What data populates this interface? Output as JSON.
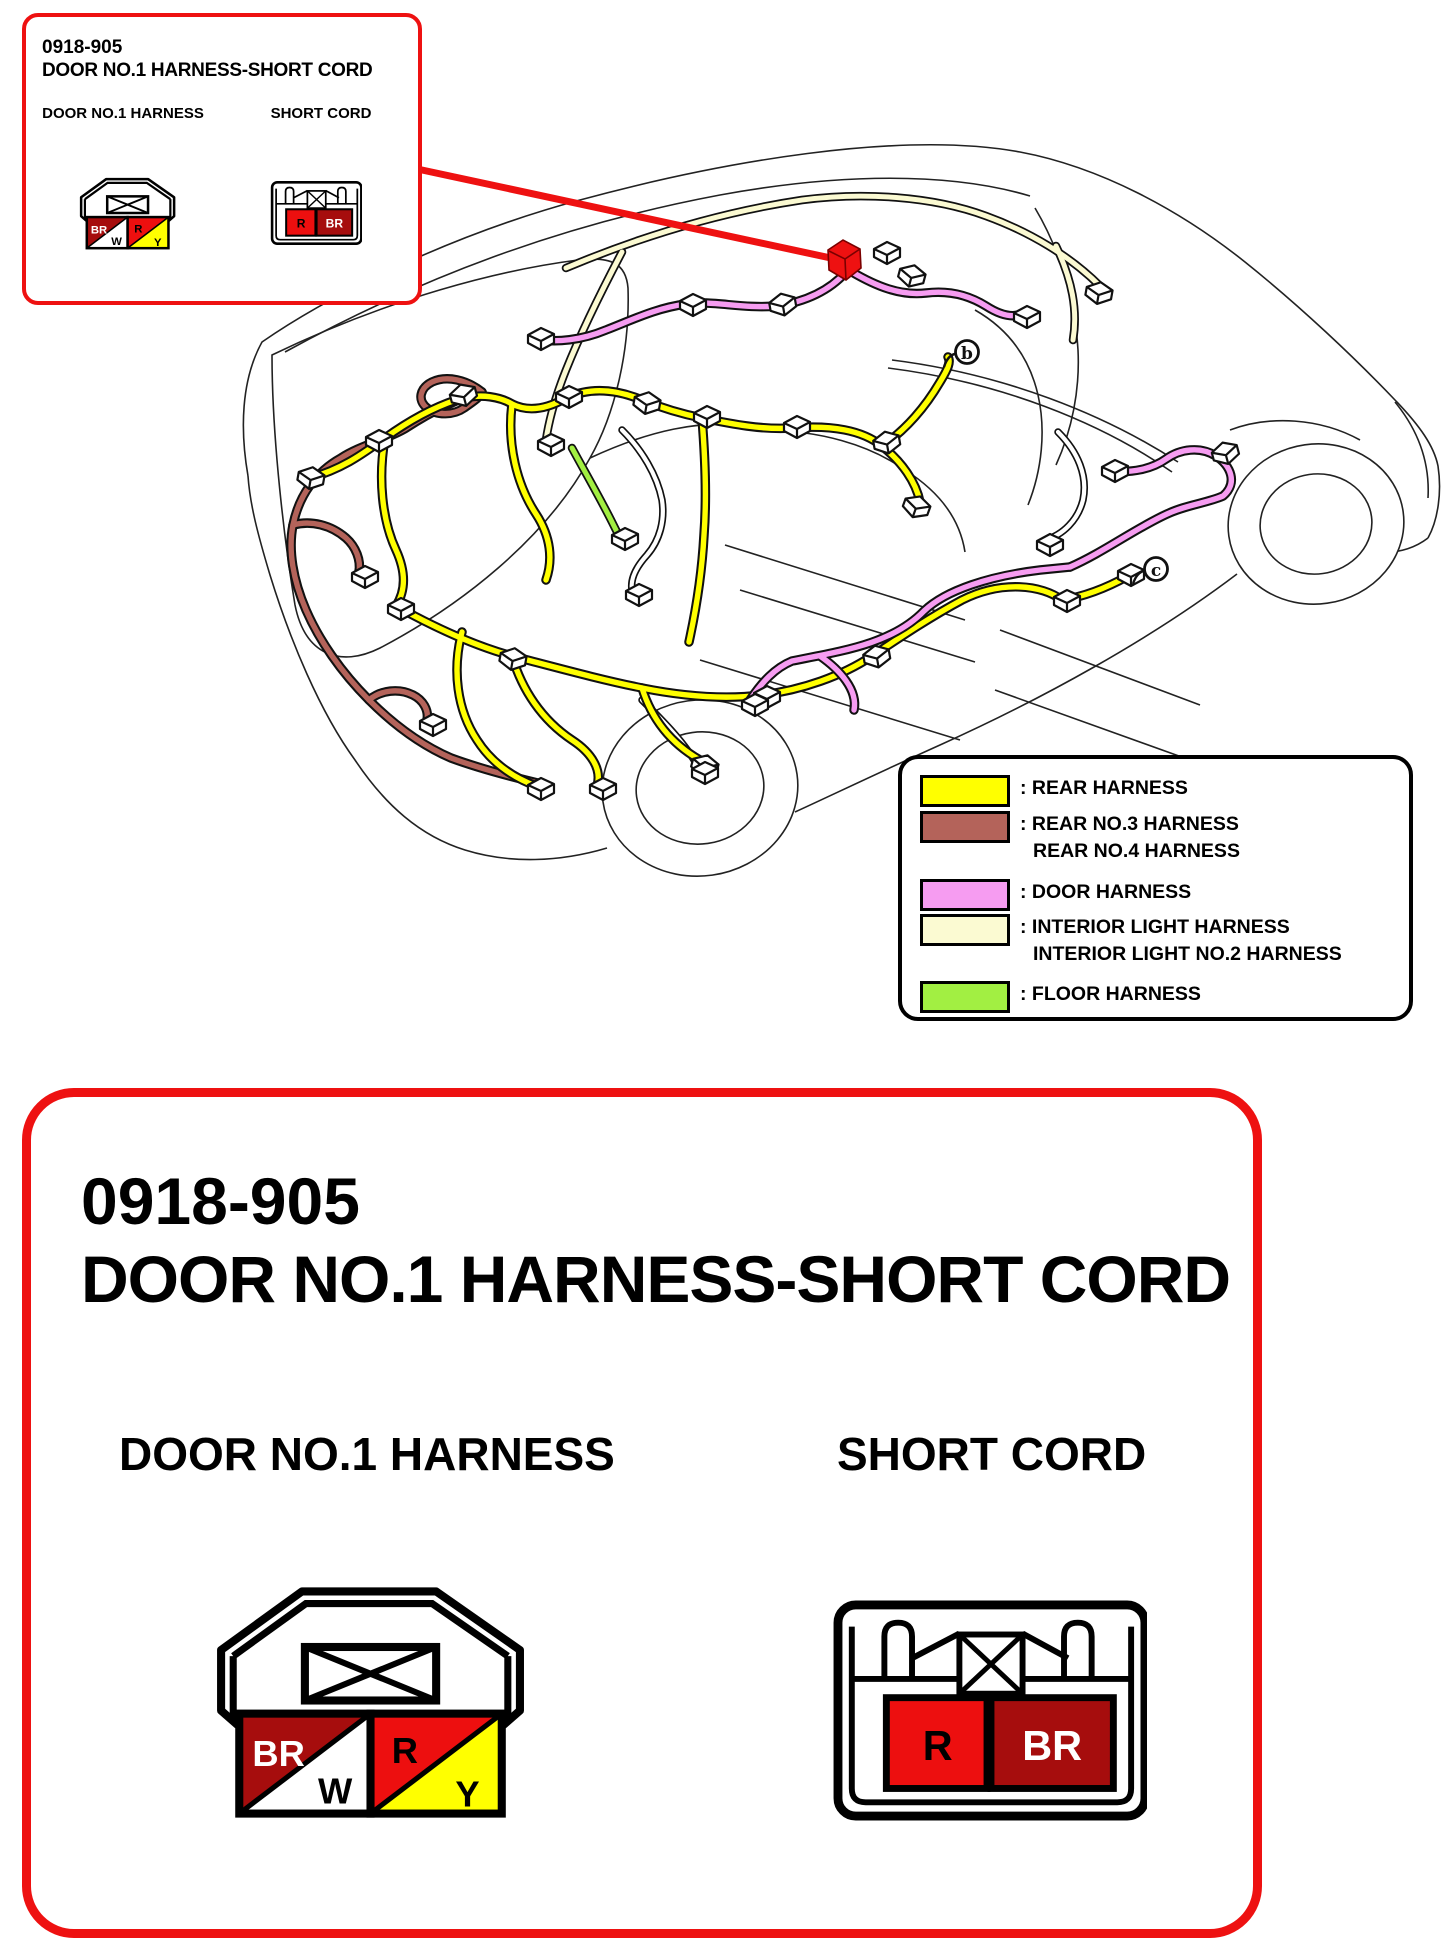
{
  "colors": {
    "accent_red": "#EE1111",
    "connector_red": "#ED0F0F",
    "connector_dark_red": "#A60D0D",
    "cell_white": "#FFFFFF",
    "cell_yellow": "#FFFF00",
    "rear_harness": "#FFFF00",
    "rear_no3_no4_harness": "#B4635A",
    "door_harness": "#F69CF1",
    "interior_light_harness": "#FBFAD2",
    "floor_harness": "#A2EF42"
  },
  "overview_callout": {
    "part_number": "0918-905",
    "title": "DOOR NO.1 HARNESS-SHORT CORD",
    "door_label": "DOOR NO.1 HARNESS",
    "short_cord_label": "SHORT CORD"
  },
  "diagram": {
    "marker_b": "b",
    "marker_c": "c"
  },
  "legend": {
    "items": [
      {
        "swatch": "#FFFF00",
        "line1": ": REAR HARNESS",
        "line2": ""
      },
      {
        "swatch": "#B4635A",
        "line1": ": REAR NO.3 HARNESS",
        "line2": "REAR NO.4 HARNESS"
      },
      {
        "swatch": "#F69CF1",
        "line1": ": DOOR HARNESS",
        "line2": ""
      },
      {
        "swatch": "#FBFAD2",
        "line1": ": INTERIOR LIGHT HARNESS",
        "line2": "INTERIOR LIGHT NO.2 HARNESS"
      },
      {
        "swatch": "#A2EF42",
        "line1": ": FLOOR HARNESS",
        "line2": ""
      }
    ]
  },
  "detail_panel": {
    "part_number": "0918-905",
    "title": "DOOR NO.1 HARNESS-SHORT CORD",
    "door_label": "DOOR NO.1 HARNESS",
    "short_cord_label": "SHORT CORD",
    "door_connector": {
      "cell1_top": "BR",
      "cell1_bottom": "W",
      "cell2_top": "R",
      "cell2_bottom": "Y"
    },
    "short_cord_connector": {
      "cell1": "R",
      "cell2": "BR"
    }
  }
}
